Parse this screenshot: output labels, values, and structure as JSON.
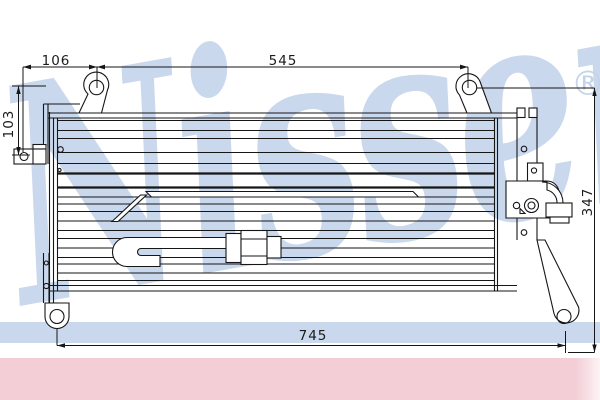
{
  "brand_watermark": {
    "name": "Nissens",
    "registered_symbol": "®"
  },
  "dimension_labels": {
    "top_left": "106",
    "top_center": "545",
    "left_side": "103",
    "right_side": "347",
    "bottom": "745"
  },
  "colors": {
    "watermark_blue": "#c9d8ed",
    "underline_band_blue": "#c9d8ec",
    "footer_band_pink": "#f3ced6",
    "line_black": "#161616",
    "background_white": "#ffffff"
  }
}
